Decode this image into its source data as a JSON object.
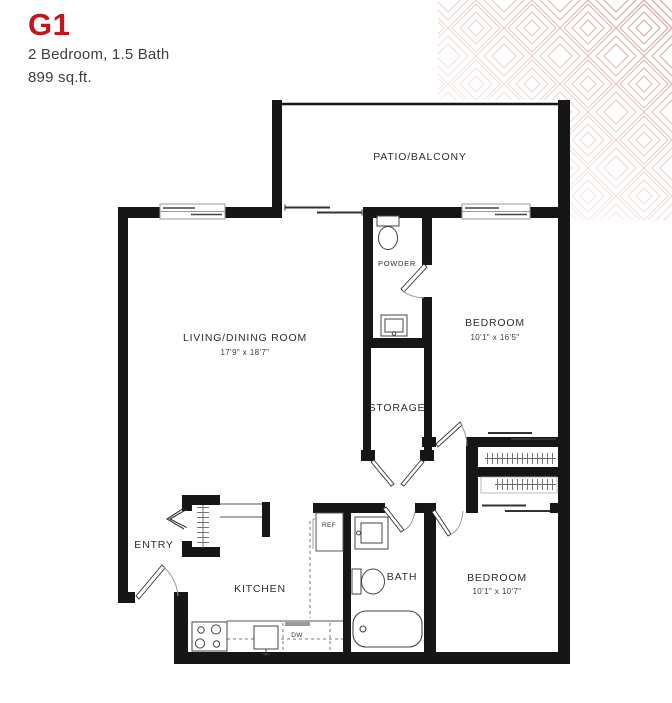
{
  "header": {
    "unit": "G1",
    "type": "2 Bedroom, 1.5 Bath",
    "area": "899 sq.ft."
  },
  "colors": {
    "accent": "#c3161c",
    "walls": "#161616",
    "pattern": "#d9a79f"
  },
  "rooms": {
    "patio": {
      "label": "PATIO/BALCONY"
    },
    "living": {
      "label": "LIVING/DINING ROOM",
      "dims": "17'9\" x 18'7\""
    },
    "bedroom1": {
      "label": "BEDROOM",
      "dims": "10'1\" x 16'5\""
    },
    "powder": {
      "label": "POWDER"
    },
    "storage": {
      "label": "STORAGE"
    },
    "entry": {
      "label": "ENTRY"
    },
    "kitchen": {
      "label": "KITCHEN"
    },
    "bath": {
      "label": "BATH"
    },
    "bedroom2": {
      "label": "BEDROOM",
      "dims": "10'1\" x 10'7\""
    }
  },
  "appliances": {
    "fridge": "REF",
    "dishwasher": "DW"
  }
}
